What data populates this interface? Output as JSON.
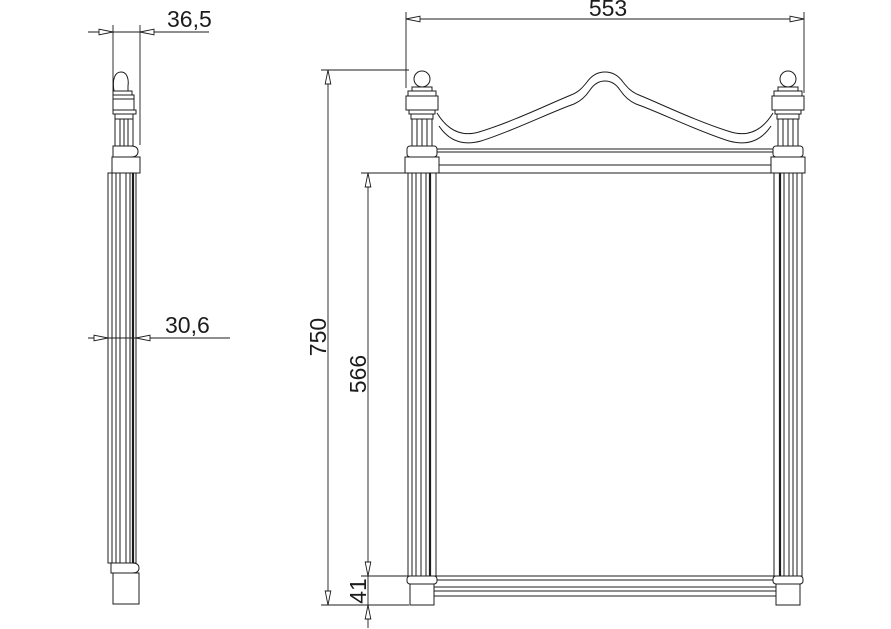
{
  "drawing": {
    "background": "#ffffff",
    "line_color": "#1c1c1c",
    "views": {
      "side": {
        "dims": {
          "top_depth": "36,5",
          "frame_depth": "30,6"
        }
      },
      "front": {
        "dims": {
          "width": "553",
          "total_height": "750",
          "mirror_height": "566",
          "base_height": "41"
        }
      }
    }
  }
}
